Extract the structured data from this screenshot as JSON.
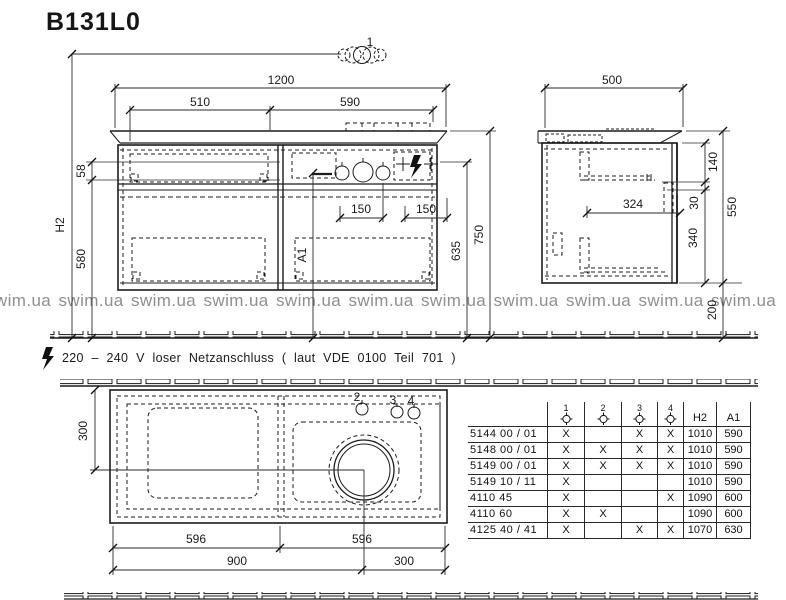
{
  "title": "B131L0",
  "watermark": {
    "text": "swim.ua",
    "count": 11
  },
  "note": "220 – 240 V loser Netzanschluss ( laut VDE 0100 Teil 701 )",
  "front": {
    "w": "1200",
    "w_left": "510",
    "w_right": "590",
    "h_gap": "58",
    "h_drawer": "580",
    "s1": "150",
    "s2": "150",
    "h_mid": "635",
    "h_top": "750",
    "h2": "H2",
    "a1": "A1",
    "tap": "1"
  },
  "side": {
    "w": "500",
    "t": "140",
    "g": "30",
    "d": "340",
    "h": "550",
    "inner": "324",
    "floor": "200"
  },
  "plan": {
    "depth": "300",
    "h2": "2",
    "h3": "3",
    "h4": "4",
    "l1": "596",
    "l2": "596",
    "b1": "900",
    "b2": "300"
  },
  "table": {
    "col_headers": [
      "1",
      "2",
      "3",
      "4",
      "H2",
      "A1"
    ],
    "rows": [
      {
        "model": "5144 00 / 01",
        "holes": [
          "X",
          "",
          "X",
          "X"
        ],
        "h2": "1010",
        "a1": "590"
      },
      {
        "model": "5148 00 / 01",
        "holes": [
          "X",
          "X",
          "X",
          "X"
        ],
        "h2": "1010",
        "a1": "590"
      },
      {
        "model": "5149 00 / 01",
        "holes": [
          "X",
          "X",
          "X",
          "X"
        ],
        "h2": "1010",
        "a1": "590"
      },
      {
        "model": "5149 10 / 11",
        "holes": [
          "X",
          "",
          "",
          ""
        ],
        "h2": "1010",
        "a1": "590"
      },
      {
        "model": "4110 45",
        "holes": [
          "X",
          "",
          "",
          "X"
        ],
        "h2": "1090",
        "a1": "600"
      },
      {
        "model": "4110 60",
        "holes": [
          "X",
          "X",
          "",
          ""
        ],
        "h2": "1090",
        "a1": "600"
      },
      {
        "model": "4125 40 / 41",
        "holes": [
          "X",
          "",
          "X",
          "X"
        ],
        "h2": "1070",
        "a1": "630"
      }
    ]
  }
}
